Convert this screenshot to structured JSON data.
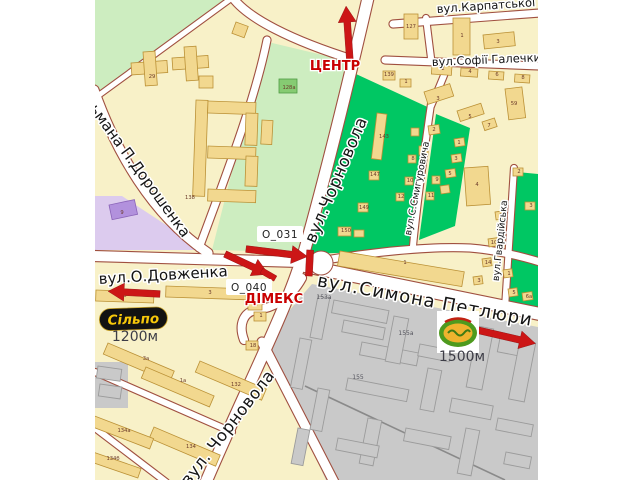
{
  "streets": {
    "karpatskoi_sichi": "вул.Карпатської Січі",
    "sofii_halechko": "вул.Софії Галечки",
    "chornovola": "вул.Чорновола",
    "chornovola_south": "вул. Чорновола",
    "symona_petliury": "вул.Симона Петлюри",
    "dovzhenka": "вул.О.Довженка",
    "doroshenka": "ьмана П.Дорошенка",
    "smyhurovycha": "вул.С.Смигуровича",
    "hvardiiska": "вул.Гвардійська"
  },
  "markers": {
    "center_direction": "ЦЕНТР",
    "dimeks": "ДІМЕКС",
    "billboard_1": "O_031",
    "billboard_2": "O_040",
    "distance_west": "1200м",
    "distance_east": "1500м",
    "silpo_logo": "Сільпо"
  },
  "colors": {
    "block": "#F8F1C8",
    "park": "#CDEDC0",
    "quarter_green": "#00C763",
    "purple_zone": "#DCCBEE",
    "industrial": "#C9C9C9",
    "road_casing": "#A05040",
    "accent_red": "#CC1616",
    "building": "#F2D88F"
  },
  "buildings": [
    {
      "t": "29",
      "x": 152,
      "y": 78
    },
    {
      "t": "138",
      "x": 190,
      "y": 199
    },
    {
      "t": "128а",
      "x": 289,
      "y": 89
    },
    {
      "t": "127",
      "x": 411,
      "y": 28
    },
    {
      "t": "1",
      "x": 462,
      "y": 37
    },
    {
      "t": "3",
      "x": 498,
      "y": 43
    },
    {
      "t": "139",
      "x": 389,
      "y": 76
    },
    {
      "t": "1",
      "x": 406,
      "y": 83
    },
    {
      "t": "2",
      "x": 443,
      "y": 70
    },
    {
      "t": "4",
      "x": 470,
      "y": 73
    },
    {
      "t": "6",
      "x": 497,
      "y": 76
    },
    {
      "t": "8",
      "x": 523,
      "y": 79
    },
    {
      "t": "3",
      "x": 438,
      "y": 100
    },
    {
      "t": "5",
      "x": 470,
      "y": 118
    },
    {
      "t": "7",
      "x": 489,
      "y": 127
    },
    {
      "t": "59",
      "x": 514,
      "y": 105
    },
    {
      "t": "143",
      "x": 384,
      "y": 138
    },
    {
      "t": "147",
      "x": 375,
      "y": 176
    },
    {
      "t": "149",
      "x": 364,
      "y": 209
    },
    {
      "t": "150",
      "x": 346,
      "y": 232
    },
    {
      "t": "4",
      "x": 424,
      "y": 151
    },
    {
      "t": "8",
      "x": 413,
      "y": 160
    },
    {
      "t": "10",
      "x": 410,
      "y": 182
    },
    {
      "t": "12",
      "x": 401,
      "y": 198
    },
    {
      "t": "9",
      "x": 437,
      "y": 181
    },
    {
      "t": "11",
      "x": 431,
      "y": 197
    },
    {
      "t": "2",
      "x": 434,
      "y": 131
    },
    {
      "t": "1",
      "x": 459,
      "y": 144
    },
    {
      "t": "3",
      "x": 456,
      "y": 160
    },
    {
      "t": "5",
      "x": 450,
      "y": 175
    },
    {
      "t": "4",
      "x": 477,
      "y": 186
    },
    {
      "t": "2",
      "x": 519,
      "y": 173
    },
    {
      "t": "3",
      "x": 531,
      "y": 207
    },
    {
      "t": "9",
      "x": 501,
      "y": 217
    },
    {
      "t": "10",
      "x": 494,
      "y": 244
    },
    {
      "t": "14",
      "x": 488,
      "y": 264
    },
    {
      "t": "3",
      "x": 479,
      "y": 282
    },
    {
      "t": "1",
      "x": 509,
      "y": 275
    },
    {
      "t": "5",
      "x": 514,
      "y": 294
    },
    {
      "t": "6а",
      "x": 529,
      "y": 298
    },
    {
      "t": "1",
      "x": 405,
      "y": 264
    },
    {
      "t": "5",
      "x": 125,
      "y": 297
    },
    {
      "t": "3",
      "x": 210,
      "y": 294
    },
    {
      "t": "1",
      "x": 256,
      "y": 306
    },
    {
      "t": "1",
      "x": 261,
      "y": 317
    },
    {
      "t": "18",
      "x": 253,
      "y": 347
    },
    {
      "t": "3а",
      "x": 146,
      "y": 360
    },
    {
      "t": "1а",
      "x": 183,
      "y": 382
    },
    {
      "t": "132",
      "x": 236,
      "y": 386
    },
    {
      "t": "134",
      "x": 191,
      "y": 448
    },
    {
      "t": "134а",
      "x": 124,
      "y": 432
    },
    {
      "t": "134б",
      "x": 113,
      "y": 460
    },
    {
      "t": "9",
      "x": 122,
      "y": 214
    },
    {
      "t": "153а",
      "x": 324,
      "y": 299,
      "g": 1
    },
    {
      "t": "155а",
      "x": 406,
      "y": 335,
      "g": 1
    },
    {
      "t": "155",
      "x": 358,
      "y": 379,
      "g": 1
    }
  ]
}
